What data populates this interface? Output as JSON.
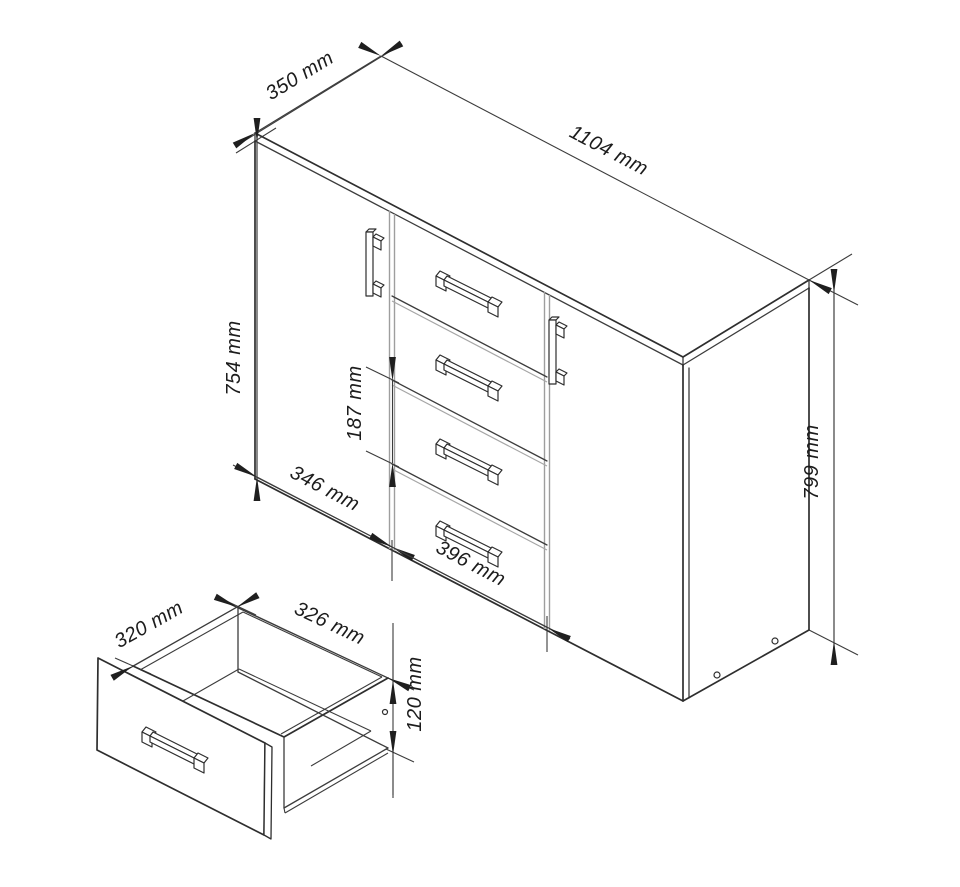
{
  "figure": {
    "background": "#ffffff",
    "line_color": "#2e2e2e",
    "dimension_color": "#3c3c3c",
    "unit": "mm"
  },
  "dimensions": {
    "main": {
      "top_depth": "350 mm",
      "top_width": "1104 mm",
      "front_height": "754 mm",
      "drawer_front_height": "187 mm",
      "left_door_width": "346 mm",
      "drawer_width": "396 mm",
      "side_height": "799 mm"
    },
    "detail": {
      "inner_depth": "320 mm",
      "inner_width": "326 mm",
      "side_height": "120 mm"
    }
  }
}
